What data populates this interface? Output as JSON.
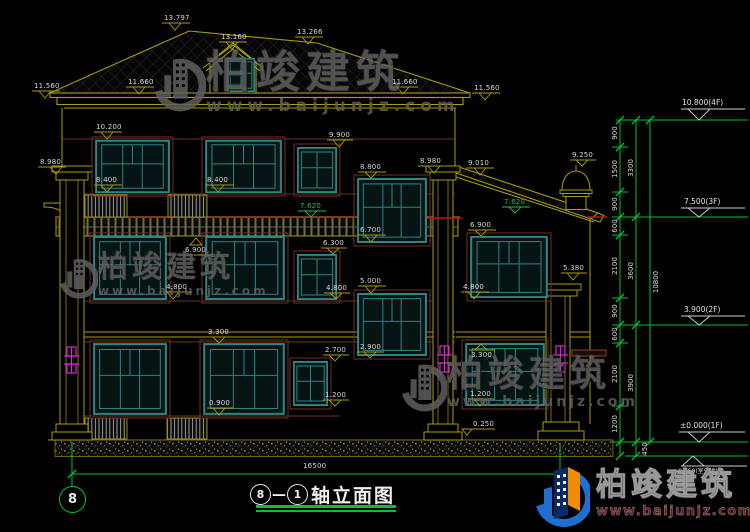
{
  "watermark": {
    "brand": "柏竣建筑",
    "url": "www.baijunjz.com"
  },
  "logo": {
    "brand": "柏竣建筑",
    "url": "www.baijunjz.com"
  },
  "title": {
    "axis_start": "8",
    "separator": "—",
    "axis_end": "1",
    "name": "轴立面图",
    "grid_bubble": "8"
  },
  "dims": {
    "overall_width": "16500",
    "overall_height": "10800",
    "ground_offset": "450",
    "detail": [
      "900",
      "1500",
      "900",
      "600",
      "2100",
      "900",
      "600",
      "2100",
      "1200"
    ],
    "floors": [
      "3300",
      "3600",
      "3900"
    ]
  },
  "levels": [
    {
      "t": "10.800(4F)"
    },
    {
      "t": "7.500(3F)"
    },
    {
      "t": "3.900(2F)"
    },
    {
      "t": "±0.000(1F)"
    },
    {
      "t": "-0.450(室外地坪)"
    }
  ],
  "spots": [
    {
      "t": "13.797"
    },
    {
      "t": "13.160"
    },
    {
      "t": "13.266"
    },
    {
      "t": "11.660"
    },
    {
      "t": "11.560"
    },
    {
      "t": "11.660"
    },
    {
      "t": "11.560"
    },
    {
      "t": "10.200"
    },
    {
      "t": "9.900"
    },
    {
      "t": "8.980"
    },
    {
      "t": "8.980"
    },
    {
      "t": "9.010"
    },
    {
      "t": "9.250"
    },
    {
      "t": "8.400"
    },
    {
      "t": "8.400"
    },
    {
      "t": "8.800"
    },
    {
      "t": "7.620"
    },
    {
      "t": "7.620"
    },
    {
      "t": "6.900"
    },
    {
      "t": "6.900"
    },
    {
      "t": "6.700"
    },
    {
      "t": "6.300"
    },
    {
      "t": "5.380"
    },
    {
      "t": "5.000"
    },
    {
      "t": "4.800"
    },
    {
      "t": "4.800"
    },
    {
      "t": "4.800"
    },
    {
      "t": "3.300"
    },
    {
      "t": "3.300"
    },
    {
      "t": "2.900"
    },
    {
      "t": "2.700"
    },
    {
      "t": "1.200"
    },
    {
      "t": "1.200"
    },
    {
      "t": "0.900"
    },
    {
      "t": "0.250"
    }
  ]
}
